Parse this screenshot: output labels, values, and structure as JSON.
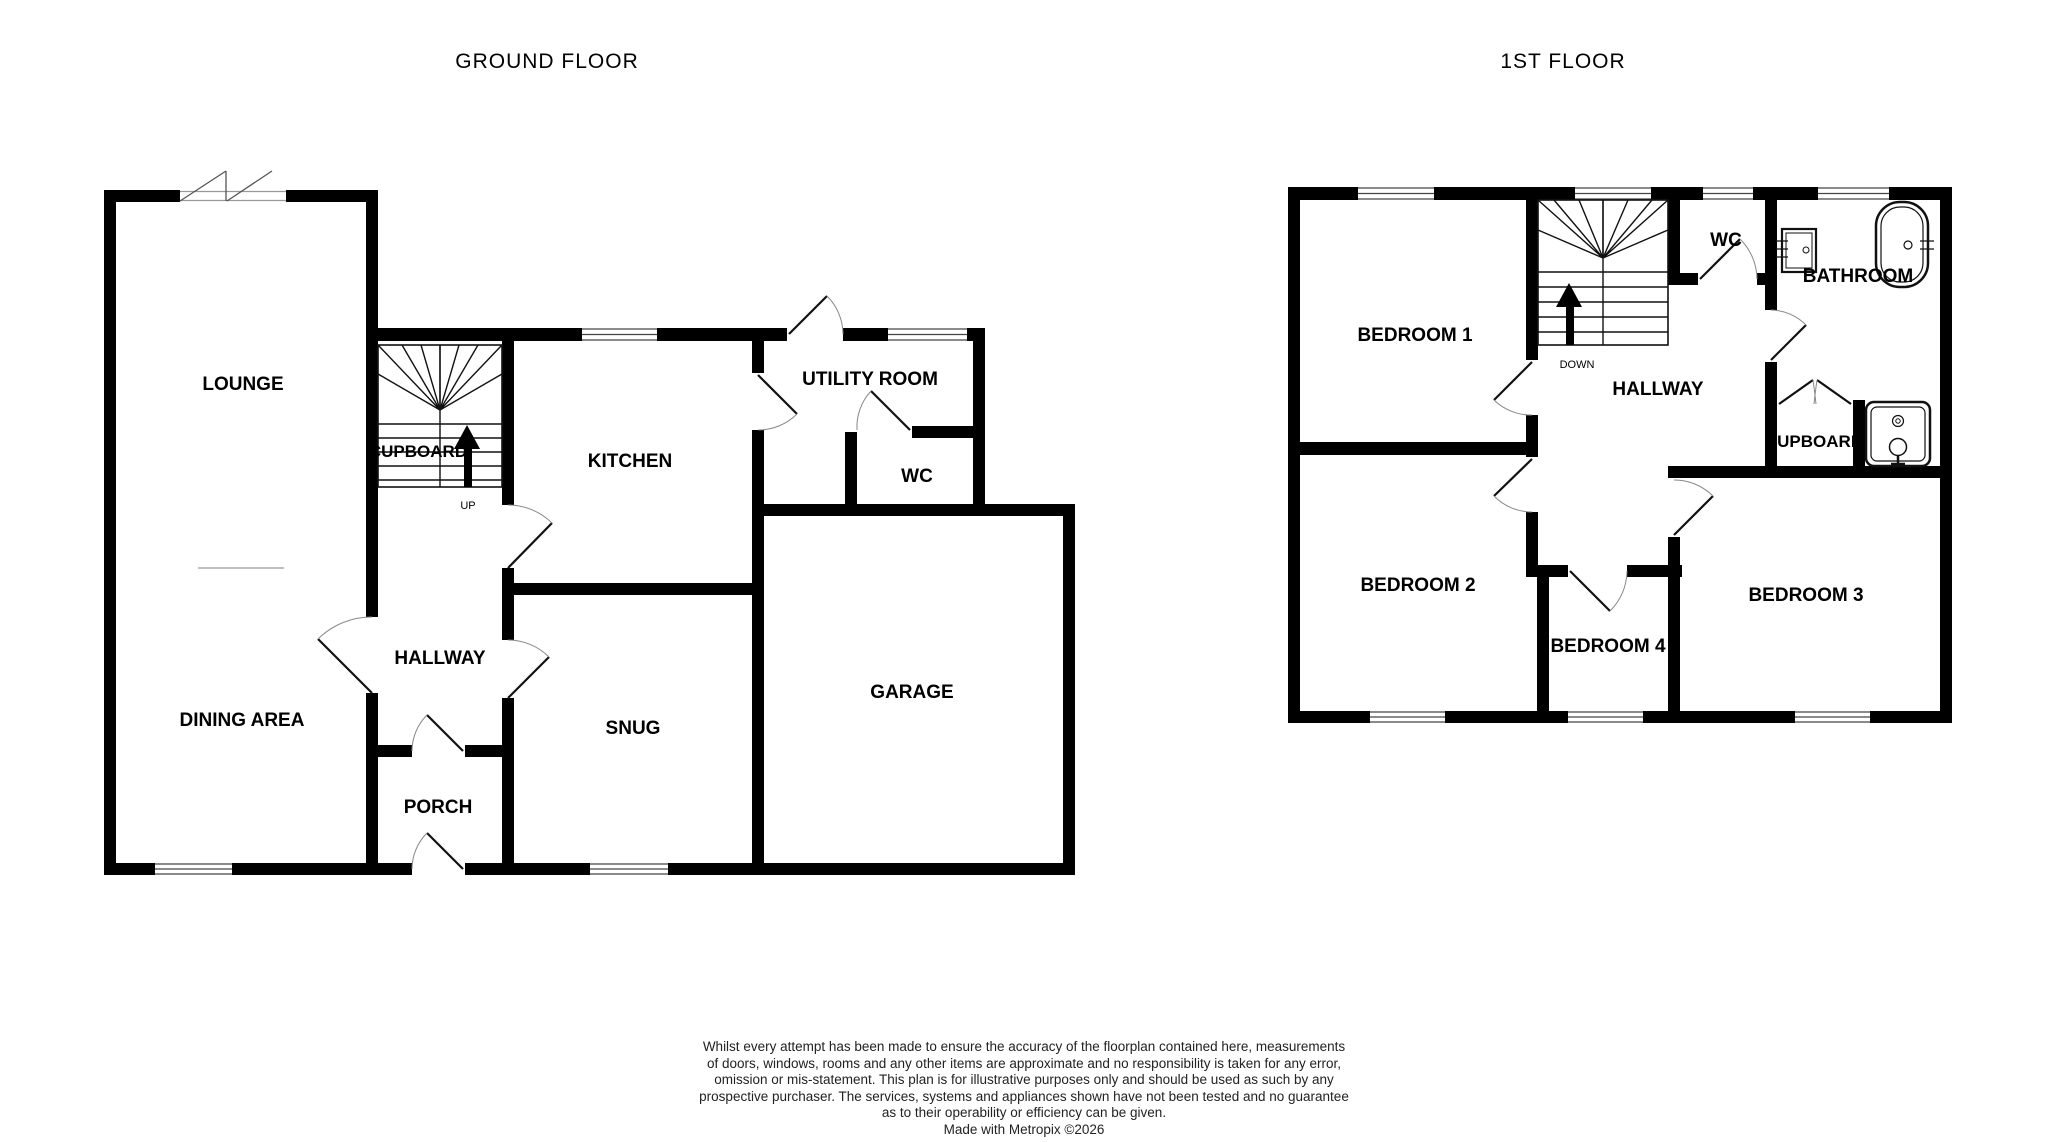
{
  "titles": {
    "ground_floor": "GROUND FLOOR",
    "first_floor": "1ST FLOOR"
  },
  "ground_floor": {
    "rooms": {
      "lounge": "LOUNGE",
      "cupboard": "CUPBOARD",
      "kitchen": "KITCHEN",
      "utility_room": "UTILITY ROOM",
      "wc": "WC",
      "hallway": "HALLWAY",
      "dining_area": "DINING AREA",
      "snug": "SNUG",
      "porch": "PORCH",
      "garage": "GARAGE"
    },
    "stair_direction": "UP"
  },
  "first_floor": {
    "rooms": {
      "bedroom1": "BEDROOM 1",
      "bedroom2": "BEDROOM 2",
      "bedroom3": "BEDROOM 3",
      "bedroom4": "BEDROOM 4",
      "hallway": "HALLWAY",
      "wc": "WC",
      "bathroom": "BATHROOM",
      "cupboard": "CUPBOARD"
    },
    "stair_direction": "DOWN"
  },
  "fixtures": {
    "bathtub": "bathtub-icon",
    "sink": "sink-icon",
    "shower": "shower-icon"
  },
  "colors": {
    "wall": "#000000",
    "label_text": "#000000",
    "door_arc": "#888888",
    "thin_line": "#999999",
    "disclaimer_text": "#222222",
    "background": "#ffffff"
  },
  "disclaimer": {
    "lines": [
      "Whilst every attempt has been made to ensure the accuracy of the floorplan contained here, measurements",
      "of doors, windows, rooms and any other items are approximate and no responsibility is taken for any error,",
      "omission or mis-statement. This plan is for illustrative purposes only and should be used as such by any",
      "prospective purchaser. The services, systems and appliances shown have not been tested and no guarantee",
      "as to their operability or efficiency can be given.",
      "Made with Metropix ©2026"
    ]
  }
}
